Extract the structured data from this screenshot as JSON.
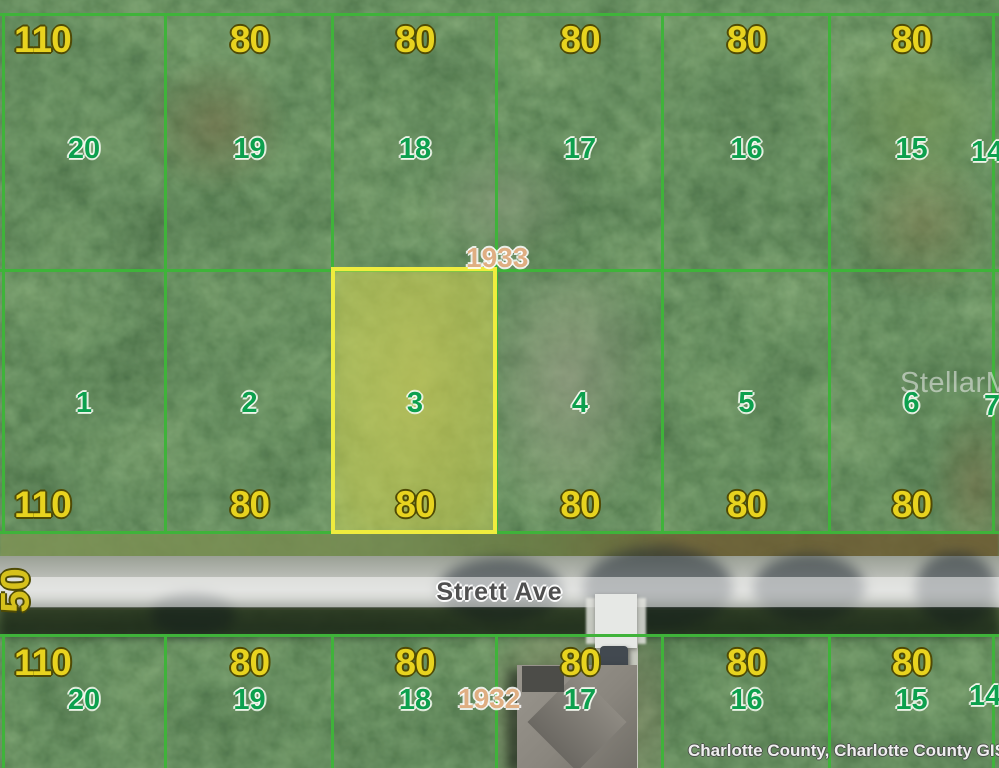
{
  "map": {
    "street": {
      "name_label": "Strett Ave",
      "right_of_way_width": "50"
    },
    "block_numbers": {
      "north": "1933",
      "south": "1932"
    },
    "highlighted_lot": "3",
    "rows": {
      "north": {
        "dims": [
          "110",
          "80",
          "80",
          "80",
          "80",
          "80"
        ],
        "lots": [
          "20",
          "19",
          "18",
          "17",
          "16",
          "15"
        ],
        "edge_lot": "14"
      },
      "middle": {
        "dims": [
          "110",
          "80",
          "80",
          "80",
          "80",
          "80"
        ],
        "lots": [
          "1",
          "2",
          "3",
          "4",
          "5",
          "6"
        ],
        "edge_lot": "7"
      },
      "south": {
        "dims": [
          "110",
          "80",
          "80",
          "80",
          "80",
          "80"
        ],
        "lots": [
          "20",
          "19",
          "18",
          "17",
          "16",
          "15"
        ],
        "edge_lot": "14"
      }
    },
    "watermarks": {
      "mls": "StellarMLS",
      "attribution": "Charlotte County, Charlotte County GIS"
    },
    "colors": {
      "lot_line": "#3fb33a",
      "highlight_line": "#efec3e",
      "dimension_text": "#e8d31f",
      "lot_number_text": "#0da04e",
      "block_number_text": "#dfae82"
    }
  }
}
